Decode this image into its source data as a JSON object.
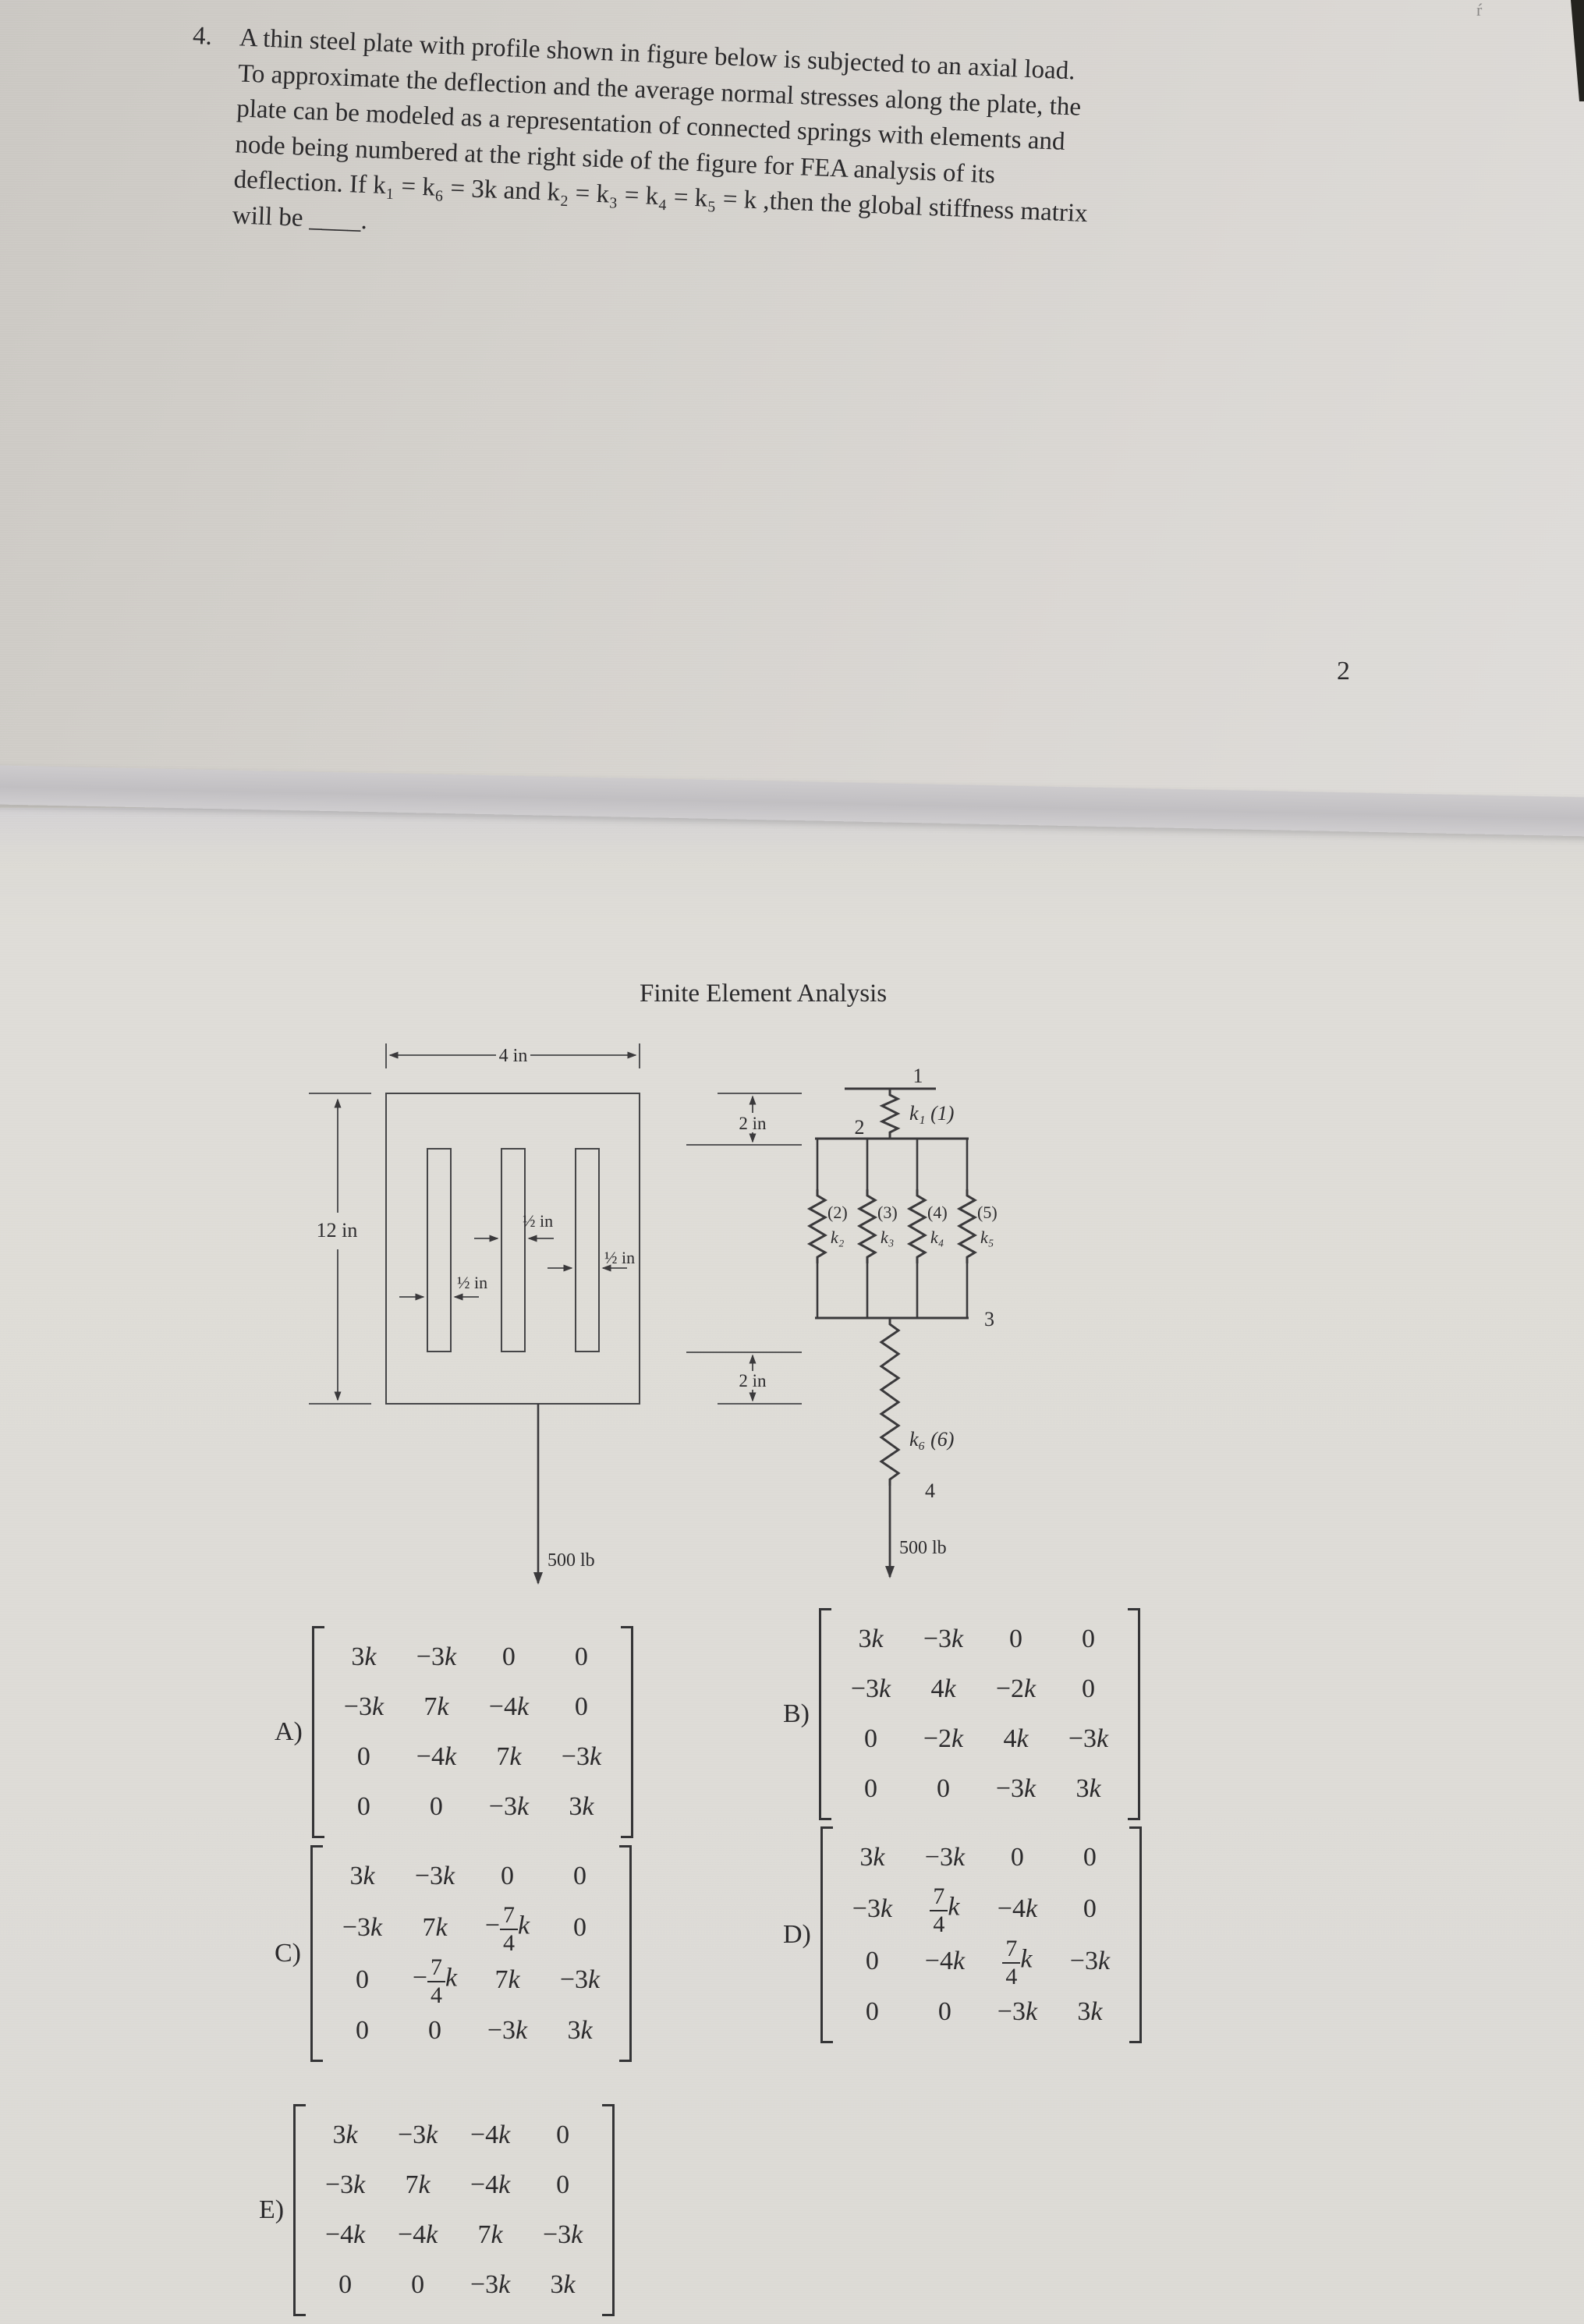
{
  "page": {
    "number": "2",
    "question": {
      "number": "4.",
      "lines": [
        "A thin steel plate with profile shown in figure below is subjected to an axial load.",
        "To approximate the deflection and the average normal stresses along the plate, the",
        "plate can be modeled as a representation of connected springs with elements and",
        "node being numbered at the right side of the figure for FEA analysis of its",
        "deflection. If k₁ = k₆ = 3k and k₂ = k₃ = k₄ = k₅ = k ,then the global stiffness matrix",
        "will be ____."
      ]
    }
  },
  "figure": {
    "title": "Finite Element Analysis",
    "plate": {
      "width_label": "4 in",
      "height_label": "12 in",
      "top_margin_label": "2 in",
      "bottom_margin_label": "2 in",
      "slot_width_labels": [
        "½ in",
        "½ in",
        "½ in"
      ],
      "load_label": "500 lb"
    },
    "springs": {
      "node_labels": [
        "1",
        "2",
        "3",
        "4"
      ],
      "element_1": "k₁ (1)",
      "parallel": [
        {
          "el": "(2)",
          "k": "k₂"
        },
        {
          "el": "(3)",
          "k": "k₃"
        },
        {
          "el": "(4)",
          "k": "k₄"
        },
        {
          "el": "(5)",
          "k": "k₅"
        }
      ],
      "element_6": "k₆ (6)",
      "load_label": "500 lb"
    }
  },
  "options": [
    {
      "label": "A)",
      "rows": [
        [
          "3k",
          "−3k",
          "0",
          "0"
        ],
        [
          "−3k",
          "7k",
          "−4k",
          "0"
        ],
        [
          "0",
          "−4k",
          "7k",
          "−3k"
        ],
        [
          "0",
          "0",
          "−3k",
          "3k"
        ]
      ]
    },
    {
      "label": "B)",
      "rows": [
        [
          "3k",
          "−3k",
          "0",
          "0"
        ],
        [
          "−3k",
          "4k",
          "−2k",
          "0"
        ],
        [
          "0",
          "−2k",
          "4k",
          "−3k"
        ],
        [
          "0",
          "0",
          "−3k",
          "3k"
        ]
      ]
    },
    {
      "label": "C)",
      "rows": [
        [
          "3k",
          "−3k",
          "0",
          "0"
        ],
        [
          "−3k",
          "7k",
          "−7/4k",
          "0"
        ],
        [
          "0",
          "−7/4k",
          "7k",
          "−3k"
        ],
        [
          "0",
          "0",
          "−3k",
          "3k"
        ]
      ]
    },
    {
      "label": "D)",
      "rows": [
        [
          "3k",
          "−3k",
          "0",
          "0"
        ],
        [
          "−3k",
          "7/4k",
          "−4k",
          "0"
        ],
        [
          "0",
          "−4k",
          "7/4k",
          "−3k"
        ],
        [
          "0",
          "0",
          "−3k",
          "3k"
        ]
      ]
    },
    {
      "label": "E)",
      "rows": [
        [
          "3k",
          "−3k",
          "−4k",
          "0"
        ],
        [
          "−3k",
          "7k",
          "−4k",
          "0"
        ],
        [
          "−4k",
          "−4k",
          "7k",
          "−3k"
        ],
        [
          "0",
          "0",
          "−3k",
          "3k"
        ]
      ]
    }
  ],
  "colors": {
    "paper_top": "#d3d0cb",
    "paper_bottom": "#dcdad5",
    "fold_shadow": "#c1bfc2",
    "ink": "#2b2a2c",
    "line": "#454547"
  }
}
